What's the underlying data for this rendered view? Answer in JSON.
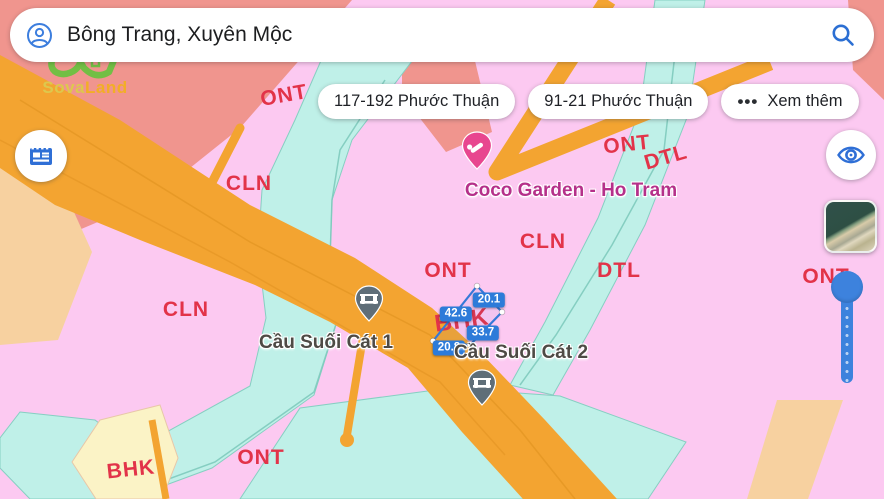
{
  "search": {
    "query": "Bông Trang, Xuyên Mộc"
  },
  "logo": {
    "name": "SovaLand",
    "part1": "Sova",
    "part2": "Land"
  },
  "chips": [
    {
      "label": "117-192 Phước Thuận",
      "icon": ""
    },
    {
      "label": "91-21 Phước Thuận",
      "icon": ""
    },
    {
      "label": "Xem thêm",
      "icon": "•••"
    }
  ],
  "icons": {
    "account": "account-icon",
    "search": "search-icon",
    "news": "newspaper-icon",
    "visibility": "eye-icon",
    "more": "ellipsis-icon",
    "bridge": "bridge-icon",
    "lodging": "lodging-icon"
  },
  "colors": {
    "accent_blue": "#2d7bd9",
    "slider_blue": "#3d82dd",
    "label_red": "#e23349",
    "zone_pink": "#fcc9f1",
    "zone_salmon": "#f0958e",
    "zone_orange": "#f3a431",
    "zone_cyan": "#bff0e8",
    "zone_cream": "#fbf3c6",
    "zone_peach": "#f7d1a0",
    "parcel_blue": "#3579d8",
    "place_magenta": "#b5308a",
    "place_gray": "#4e4a45"
  },
  "map": {
    "zone_labels": [
      {
        "text": "ONT",
        "x": 284,
        "y": 96,
        "rot": -10
      },
      {
        "text": "CLN",
        "x": 249,
        "y": 184,
        "rot": 0
      },
      {
        "text": "ONT",
        "x": 627,
        "y": 145,
        "rot": -6
      },
      {
        "text": "DTL",
        "x": 666,
        "y": 158,
        "rot": -16
      },
      {
        "text": "CLN",
        "x": 543,
        "y": 242,
        "rot": 0
      },
      {
        "text": "ONT",
        "x": 448,
        "y": 271,
        "rot": 0
      },
      {
        "text": "DTL",
        "x": 619,
        "y": 271,
        "rot": 0
      },
      {
        "text": "ONT",
        "x": 826,
        "y": 277,
        "rot": 0
      },
      {
        "text": "CLN",
        "x": 186,
        "y": 310,
        "rot": 0
      },
      {
        "text": "BHK",
        "x": 462,
        "y": 321,
        "rot": -8,
        "size": 24
      },
      {
        "text": "BHK",
        "x": 131,
        "y": 470,
        "rot": -6
      },
      {
        "text": "ONT",
        "x": 261,
        "y": 458,
        "rot": 0
      }
    ],
    "place_labels": [
      {
        "text": "Coco Garden - Ho Tram",
        "x": 571,
        "y": 191,
        "color": "#b5308a"
      },
      {
        "text": "Cầu Suối Cát 1",
        "x": 326,
        "y": 343,
        "color": "#4e4a45"
      },
      {
        "text": "Cầu Suối Cát 2",
        "x": 521,
        "y": 353,
        "color": "#4e4a45"
      }
    ],
    "parcel": {
      "points": "477,286 502,312 470,345 433,341",
      "measurements": [
        {
          "value": "20.1",
          "x": 489,
          "y": 300
        },
        {
          "value": "42.6",
          "x": 456,
          "y": 314
        },
        {
          "value": "33.7",
          "x": 483,
          "y": 333
        },
        {
          "value": "20.8",
          "x": 449,
          "y": 348
        }
      ]
    }
  }
}
